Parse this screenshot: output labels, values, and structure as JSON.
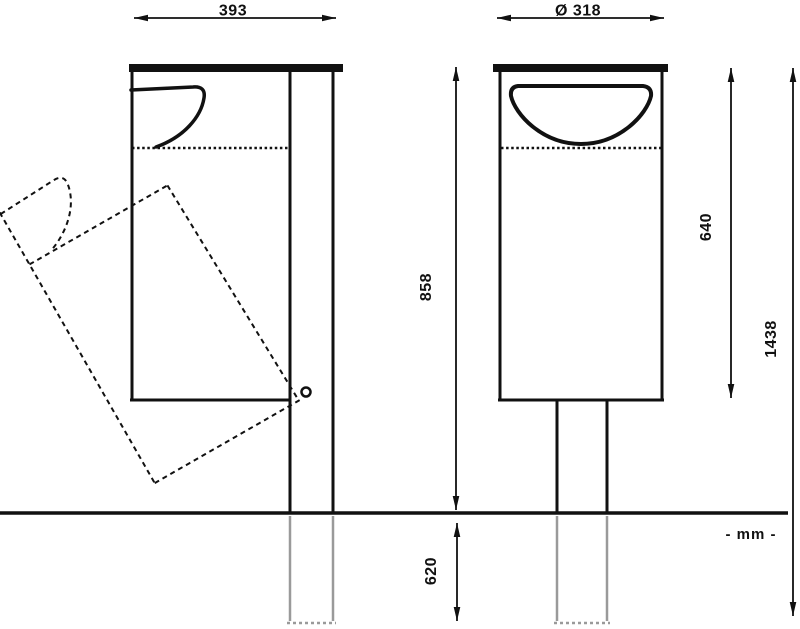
{
  "drawing": {
    "type": "technical-drawing",
    "subject": "pole-mounted tilting waste bin, side view and front view",
    "unit_label": "- mm -",
    "colors": {
      "line": "#111111",
      "underground_line": "#9a9a9a",
      "background": "#ffffff"
    },
    "dims": {
      "front_width": "393",
      "diameter": "Ø 318",
      "height_above_ground": "858",
      "underground_depth": "620",
      "bin_height": "640",
      "total_height": "1438"
    }
  }
}
